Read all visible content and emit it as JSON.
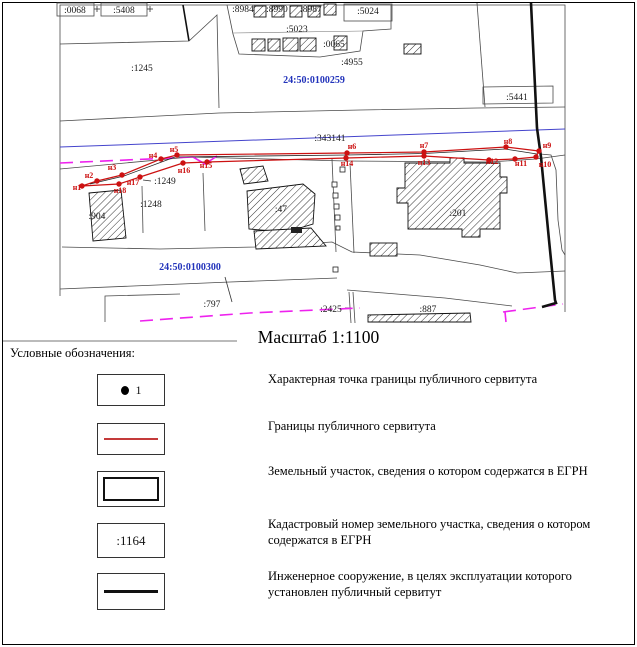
{
  "page": {
    "scale_label": "Масштаб 1:1100",
    "legend_title": "Условные обозначения:"
  },
  "legend": {
    "items": [
      {
        "symbol": "point-marker",
        "sample": "1",
        "label": "Характерная точка границы публичного сервитута"
      },
      {
        "symbol": "servitude-red-line",
        "sample": "",
        "label": "Границы публичного сервитута"
      },
      {
        "symbol": "parcel-outline",
        "sample": "",
        "label": "Земельный участок, сведения о котором содержатся в ЕГРН"
      },
      {
        "symbol": "cadastral-number",
        "sample": ":1164",
        "label": "Кадастровый номер земельного участка, сведения о котором содержатся в ЕГРН"
      },
      {
        "symbol": "engineering-line",
        "sample": "",
        "label": "Инженерное сооружение, в целях эксплуатации которого установлен публичный сервитут"
      }
    ]
  },
  "map": {
    "colors": {
      "servitude_red": "#cc1111",
      "quarter_blue": "#2233bb",
      "road_blue": "#4444cc",
      "boundary_magenta": "#ee22ee",
      "engineering_black": "#111111"
    },
    "cadastral_quarters": [
      {
        "text": "24:50:0100259",
        "x": 314,
        "y": 83
      },
      {
        "text": "24:50:0100300",
        "x": 190,
        "y": 270
      }
    ],
    "parcel_labels": [
      {
        "text": ":0068",
        "x": 75,
        "y": 13
      },
      {
        "text": ":5408",
        "x": 124,
        "y": 13
      },
      {
        "text": ":1245",
        "x": 142,
        "y": 71
      },
      {
        "text": ":8984",
        "x": 243,
        "y": 12
      },
      {
        "text": ":8990",
        "x": 277,
        "y": 12
      },
      {
        "text": ":8987",
        "x": 311,
        "y": 12
      },
      {
        "text": ":5023",
        "x": 297,
        "y": 32
      },
      {
        "text": ":5024",
        "x": 368,
        "y": 14
      },
      {
        "text": ":0065",
        "x": 334,
        "y": 47
      },
      {
        "text": ":4955",
        "x": 352,
        "y": 65
      },
      {
        "text": ":5441",
        "x": 517,
        "y": 100
      },
      {
        "text": ":343141",
        "x": 330,
        "y": 141
      },
      {
        "text": ":1249",
        "x": 165,
        "y": 184
      },
      {
        "text": ":1248",
        "x": 151,
        "y": 207
      },
      {
        "text": ":904",
        "x": 97,
        "y": 219
      },
      {
        "text": ":47",
        "x": 281,
        "y": 212
      },
      {
        "text": ":201",
        "x": 458,
        "y": 216
      },
      {
        "text": ":797",
        "x": 212,
        "y": 307
      },
      {
        "text": ":2425",
        "x": 331,
        "y": 312
      },
      {
        "text": ":887",
        "x": 428,
        "y": 312
      }
    ],
    "point_labels": [
      {
        "text": "н1",
        "x": 77,
        "y": 190
      },
      {
        "text": "н2",
        "x": 89,
        "y": 178
      },
      {
        "text": "н3",
        "x": 112,
        "y": 170
      },
      {
        "text": "н4",
        "x": 153,
        "y": 158
      },
      {
        "text": "н5",
        "x": 174,
        "y": 152
      },
      {
        "text": "н6",
        "x": 352,
        "y": 149
      },
      {
        "text": "н7",
        "x": 424,
        "y": 148
      },
      {
        "text": "н8",
        "x": 508,
        "y": 144
      },
      {
        "text": "н9",
        "x": 547,
        "y": 148
      },
      {
        "text": "н10",
        "x": 545,
        "y": 167
      },
      {
        "text": "н11",
        "x": 521,
        "y": 166
      },
      {
        "text": "н12",
        "x": 492,
        "y": 164
      },
      {
        "text": "н13",
        "x": 424,
        "y": 165
      },
      {
        "text": "н14",
        "x": 347,
        "y": 166
      },
      {
        "text": "н15",
        "x": 206,
        "y": 168
      },
      {
        "text": "н16",
        "x": 184,
        "y": 173
      },
      {
        "text": "н17",
        "x": 133,
        "y": 185
      },
      {
        "text": "н18",
        "x": 120,
        "y": 193
      }
    ],
    "point_dots": [
      [
        82,
        186
      ],
      [
        97,
        181
      ],
      [
        122,
        175
      ],
      [
        161,
        159
      ],
      [
        177,
        155
      ],
      [
        347,
        153
      ],
      [
        424,
        152
      ],
      [
        506,
        147
      ],
      [
        539,
        151
      ],
      [
        536,
        157
      ],
      [
        515,
        159
      ],
      [
        489,
        160
      ],
      [
        424,
        156
      ],
      [
        346,
        158
      ],
      [
        207,
        162
      ],
      [
        183,
        163
      ],
      [
        140,
        177
      ],
      [
        119,
        184
      ]
    ]
  }
}
